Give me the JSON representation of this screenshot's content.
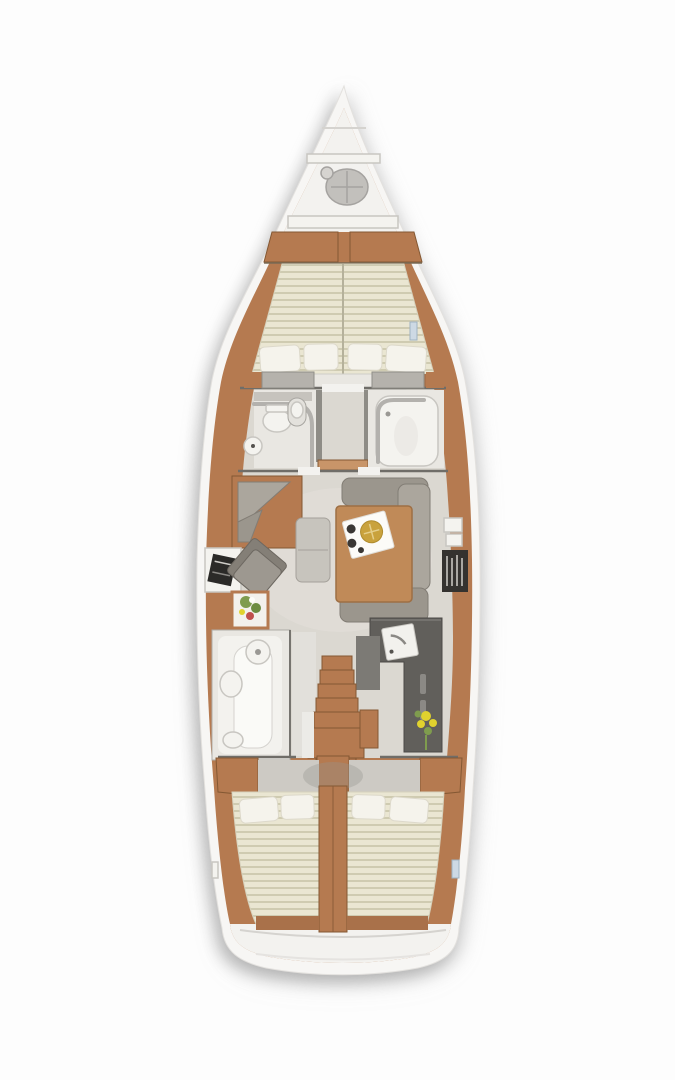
{
  "palette": {
    "background": "#fdfdfd",
    "hull_white": "#f7f6f4",
    "wood": "#b57a50",
    "wood_dark": "#a9714a",
    "wood_deep": "#845833",
    "floor_gray": "#dbd8d1",
    "floor_light": "#e9e7e2",
    "locker_white": "#f3f2ef",
    "wall_dark": "#6f6d68",
    "cushion": "#9b968d",
    "cushion_light": "#aba69d",
    "cushion_dark": "#827d75",
    "mattress_cream": "#eae6d2",
    "mattress_stripe": "#cfcbb1",
    "pillow_white": "#f5f3ec",
    "fixture_white": "#f4f3ef",
    "fixture_stroke": "#c8c6c1",
    "galley_dark": "#615f5b",
    "shelf_dark": "#34322f",
    "plate_gold": "#c9a23d",
    "flower_yellow": "#e0d22e",
    "flower_green": "#7f9c4e",
    "flower_red": "#c0504d",
    "hatch_blue": "#cdd9e4"
  },
  "areas": [
    "anchor-locker",
    "forward-cabin-v-berth",
    "port-head-toilet",
    "starboard-shower-room",
    "salon-u-sofa",
    "salon-table-with-tray",
    "nav-station-armchair",
    "flower-side-table",
    "galley-with-sink",
    "aft-port-head",
    "companionway-stairs",
    "aft-port-cabin",
    "aft-starboard-cabin",
    "transom"
  ]
}
